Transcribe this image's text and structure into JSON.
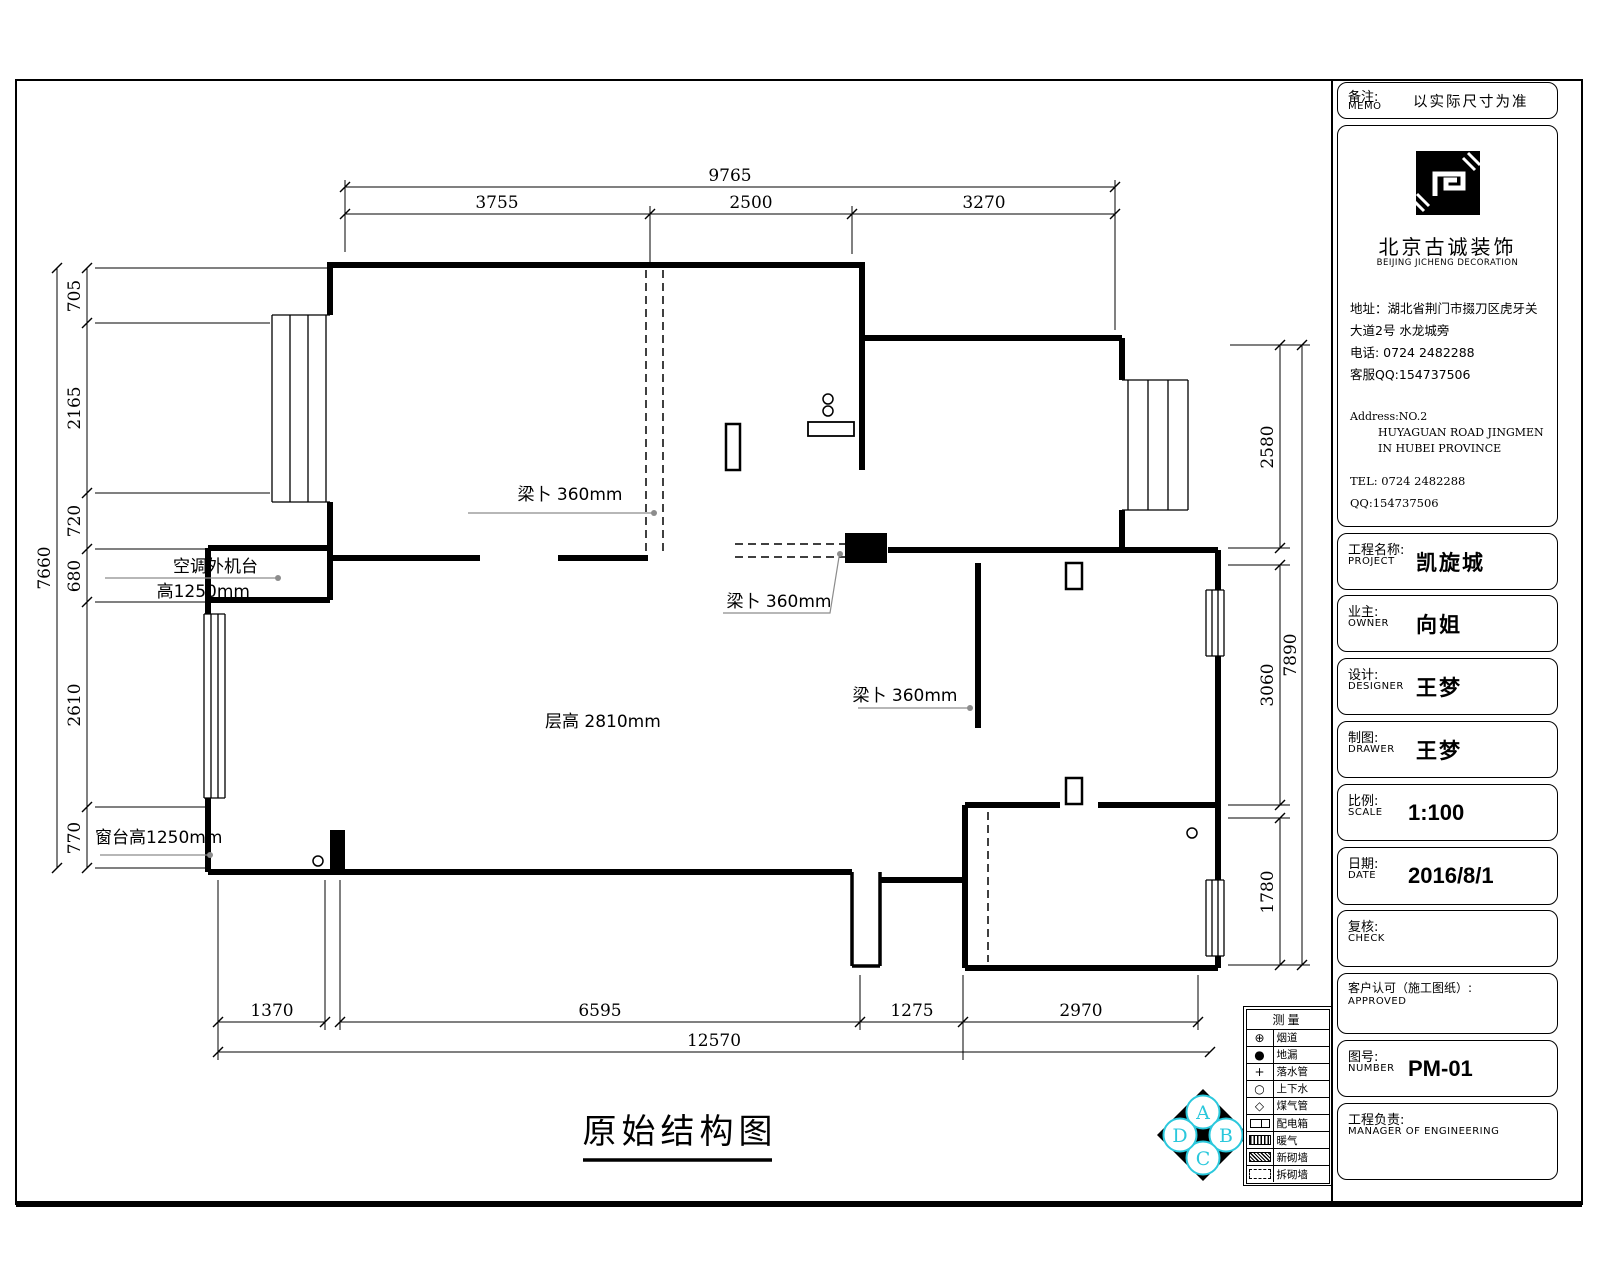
{
  "sheet": {
    "plan_title": "原始结构图",
    "colors": {
      "ink": "#000000",
      "leader_gray": "#8c8c8c",
      "accent_cyan": "#2bc8dc"
    }
  },
  "dimensions": {
    "top": {
      "overall": "9765",
      "segments": [
        "3755",
        "2500",
        "3270"
      ]
    },
    "bottom": {
      "overall": "12570",
      "segments": [
        "1370",
        "6595",
        "1275",
        "2970"
      ]
    },
    "left": {
      "overall": "7660",
      "segments": [
        "705",
        "2165",
        "720",
        "680",
        "2610",
        "770"
      ]
    },
    "right": {
      "overall": "7890",
      "segments": [
        "2580",
        "3060",
        "1780"
      ]
    }
  },
  "annotations": {
    "beam": "梁卜 360mm",
    "floor_height": "层高 2810mm",
    "ac_platform_line1": "空调外机台",
    "ac_platform_line2": "高1250mm",
    "window_sill": "窗台高1250mm"
  },
  "legend": {
    "header": "测量",
    "rows": [
      {
        "symbol": "flue-symbol",
        "label": "烟道"
      },
      {
        "symbol": "floor-drain-symbol",
        "label": "地漏"
      },
      {
        "symbol": "downpipe-symbol",
        "label": "落水管"
      },
      {
        "symbol": "water-pipe-symbol",
        "label": "上下水"
      },
      {
        "symbol": "gas-pipe-symbol",
        "label": "煤气管"
      },
      {
        "symbol": "dist-box-symbol",
        "label": "配电箱"
      },
      {
        "symbol": "heating-symbol",
        "label": "暖气"
      },
      {
        "symbol": "new-wall-symbol",
        "label": "新砌墙"
      },
      {
        "symbol": "demolish-wall-symbol",
        "label": "拆砌墙"
      }
    ]
  },
  "diamond_logo": {
    "letters": [
      "A",
      "B",
      "C",
      "D"
    ]
  },
  "title_block": {
    "memo": {
      "label_cn": "备注:",
      "label_en": "MEMO",
      "value": "以实际尺寸为准"
    },
    "company": {
      "name_cn": "北京古诚装饰",
      "name_en": "BEIJING JICHENG DECORATION",
      "address_cn_1": "地址：湖北省荆门市掇刀区虎牙关",
      "address_cn_2": "大道2号 水龙城旁",
      "phone_cn": "电话: 0724 2482288",
      "qq_cn": "客服QQ:154737506",
      "address_en_1": "Address:NO.2",
      "address_en_2": "HUYAGUAN ROAD JINGMEN",
      "address_en_3": "IN HUBEI PROVINCE",
      "tel_en": "TEL: 0724 2482288",
      "qq_en": "QQ:154737506"
    },
    "fields": [
      {
        "label_cn": "工程名称:",
        "label_en": "PROJECT",
        "value": "凯旋城"
      },
      {
        "label_cn": "业主:",
        "label_en": "OWNER",
        "value": "向姐"
      },
      {
        "label_cn": "设计:",
        "label_en": "DESIGNER",
        "value": "王梦"
      },
      {
        "label_cn": "制图:",
        "label_en": "DRAWER",
        "value": "王梦"
      },
      {
        "label_cn": "比例:",
        "label_en": "SCALE",
        "value": "1:100"
      },
      {
        "label_cn": "日期:",
        "label_en": "DATE",
        "value": "2016/8/1"
      },
      {
        "label_cn": "复核:",
        "label_en": "CHECK",
        "value": ""
      },
      {
        "label_cn": "客户认可（施工图纸）:",
        "label_en": "APPROVED",
        "value": ""
      },
      {
        "label_cn": "图号:",
        "label_en": "NUMBER",
        "value": "PM-01"
      },
      {
        "label_cn": "工程负责:",
        "label_en": "MANAGER OF ENGINEERING",
        "value": ""
      }
    ]
  }
}
